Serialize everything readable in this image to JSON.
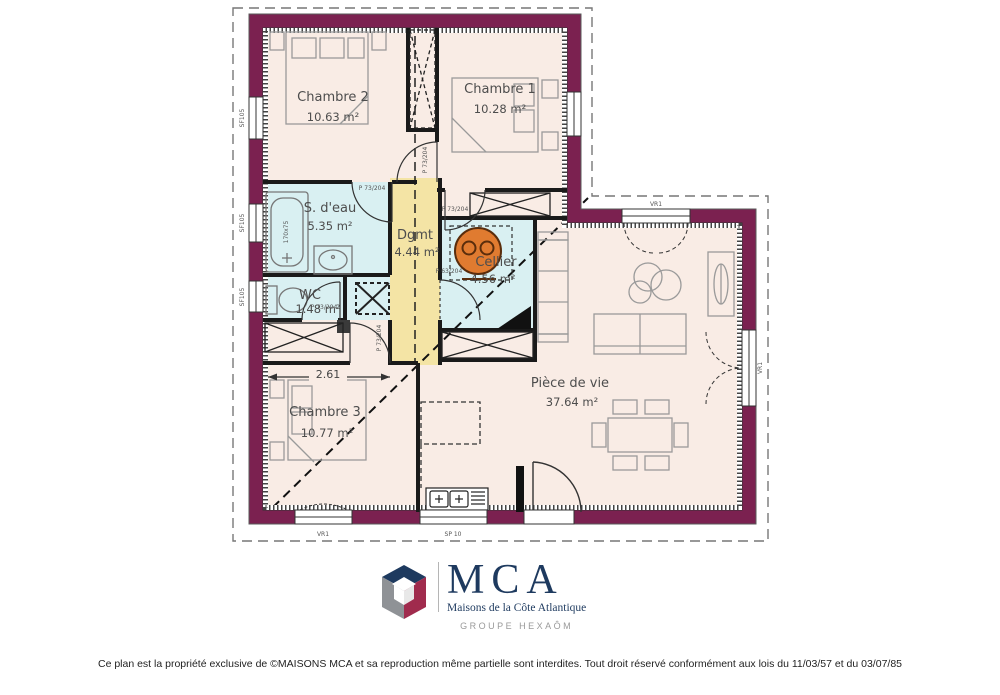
{
  "plan": {
    "rooms": {
      "chambre2": {
        "name": "Chambre 2",
        "area": "10.63 m²"
      },
      "chambre1": {
        "name": "Chambre 1",
        "area": "10.28 m²"
      },
      "sdeau": {
        "name": "S. d'eau",
        "area": "5.35 m²"
      },
      "dgmt": {
        "name": "Dgmt",
        "area": "4.44 m²"
      },
      "cellier": {
        "name": "Cellier",
        "area": "4.56 m²"
      },
      "wc": {
        "name": "WC",
        "area": "1.48 m²"
      },
      "chambre3": {
        "name": "Chambre 3",
        "area": "10.77 m²"
      },
      "piece_de_vie": {
        "name": "Pièce de vie",
        "area": "37.64 m²"
      }
    },
    "dimensions": {
      "chambre3_width": "2.61"
    },
    "labels": {
      "door_73": "P 73/204",
      "door_63": "P 63/204",
      "window_top": "VR1",
      "window_bottom": "VR1",
      "window_kitchen": "SP 10",
      "window_left": "SF105",
      "door_right": "VR1",
      "bathtub": "170x75"
    },
    "colors": {
      "wall": "#7B2150",
      "room": "#F9ECE5",
      "wet_room": "#D9F0F2",
      "hall": "#F4E4A5",
      "water_heater": "#E07B30",
      "logo_navy": "#1E3A5F",
      "logo_red": "#A02B4D",
      "logo_gray": "#8F9296"
    }
  },
  "logo": {
    "acronym": "MCA",
    "company": "Maisons de la Côte Atlantique",
    "group": "GROUPE HEXAÔM"
  },
  "footer": {
    "copyright": "Ce plan est la propriété exclusive de ©MAISONS MCA et sa reproduction même partielle sont interdites. Tout droit réservé conformément aux lois du 11/03/57 et du 03/07/85"
  }
}
